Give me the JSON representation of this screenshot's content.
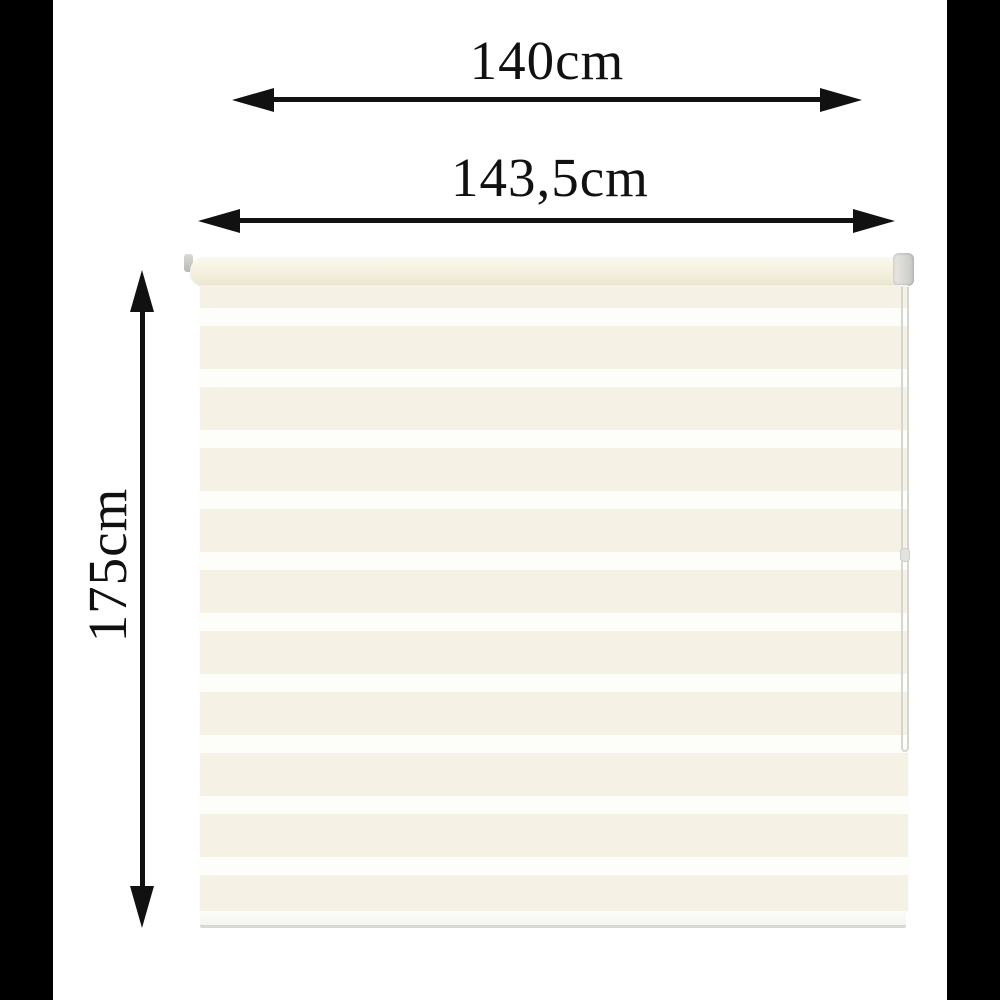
{
  "annotations": {
    "top_width": "140cm",
    "total_width": "143,5cm",
    "height": "175cm"
  },
  "colors": {
    "background": "#ffffff",
    "pillarbox": "#000000",
    "arrow": "#111111",
    "text": "#111111",
    "fabric_cream": "#f5f1e4",
    "fabric_white": "#fdfdf9",
    "tube": "#f4f0de",
    "hardware_gray": "#c7c7c3"
  }
}
